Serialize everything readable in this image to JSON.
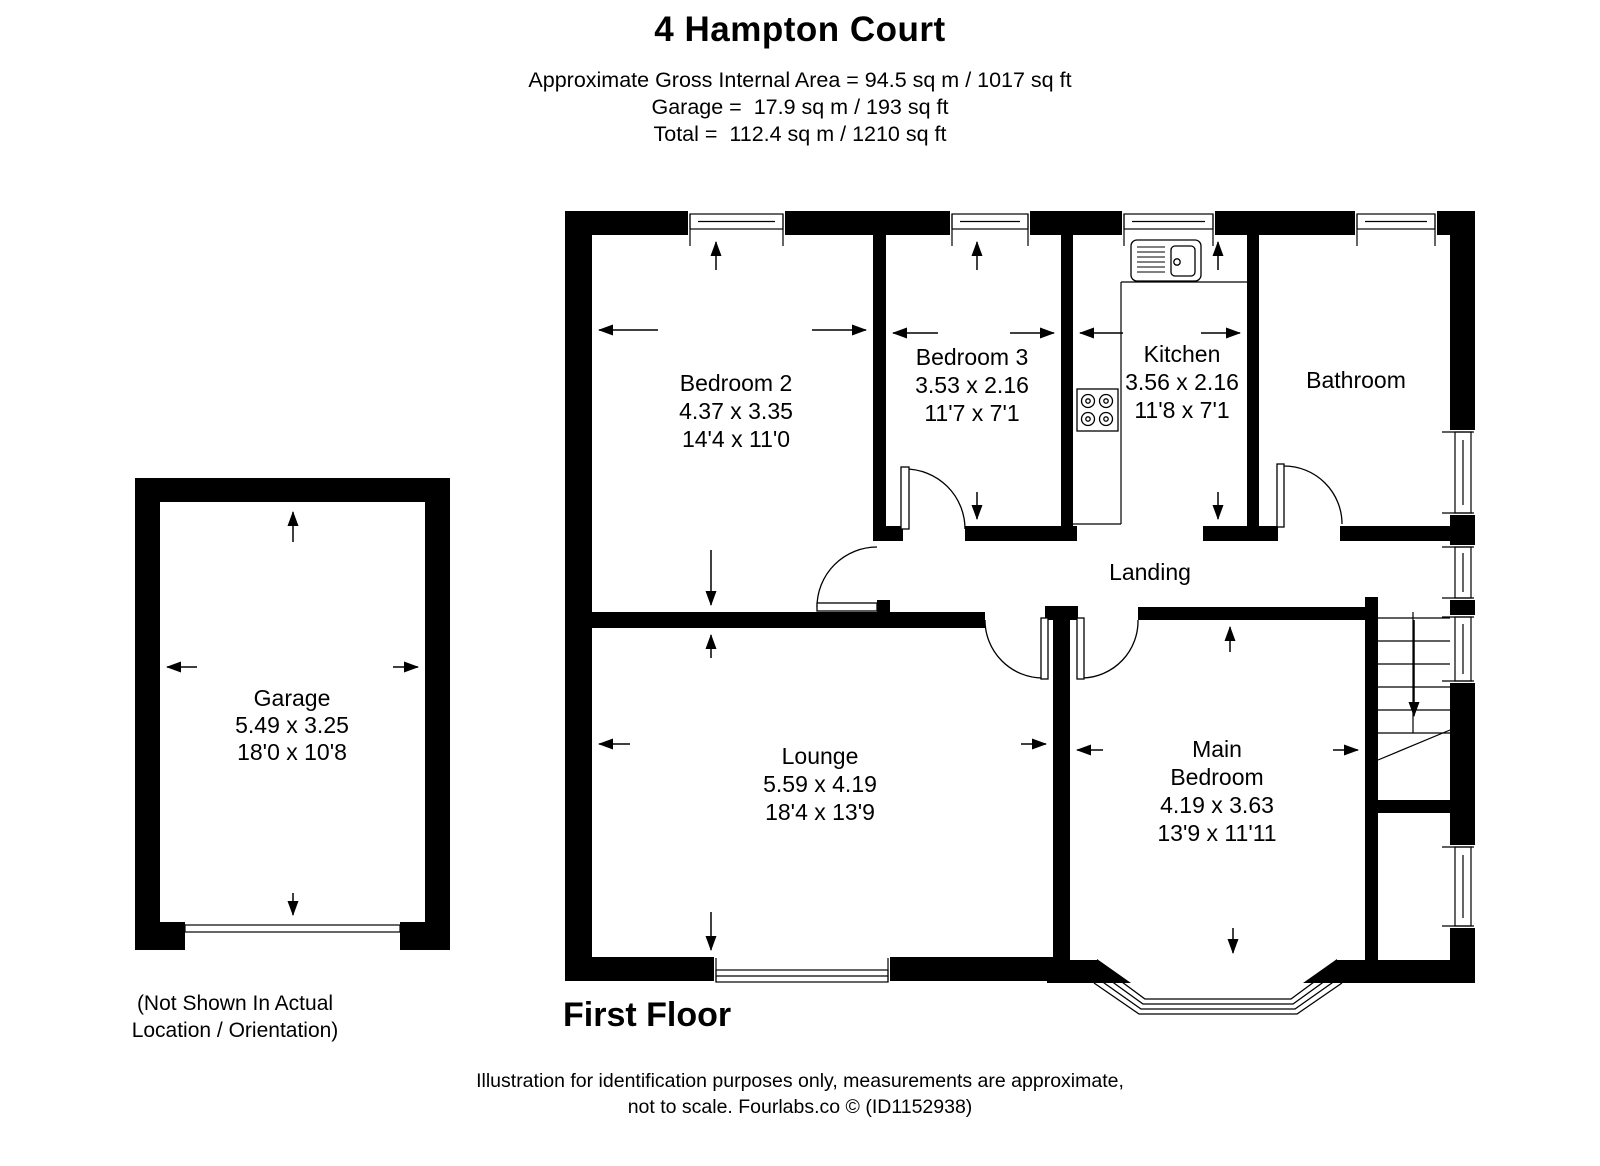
{
  "header": {
    "title": "4 Hampton Court",
    "area_line1": "Approximate Gross Internal Area = 94.5 sq m / 1017 sq ft",
    "area_line2": "Garage =  17.9 sq m / 193 sq ft",
    "area_line3": "Total =  112.4 sq m / 1210 sq ft"
  },
  "rooms": {
    "bedroom2": {
      "name": "Bedroom 2",
      "metric": "4.37 x 3.35",
      "imperial": "14'4 x 11'0"
    },
    "bedroom3": {
      "name": "Bedroom 3",
      "metric": "3.53 x 2.16",
      "imperial": "11'7 x 7'1"
    },
    "kitchen": {
      "name": "Kitchen",
      "metric": "3.56 x 2.16",
      "imperial": "11'8 x 7'1"
    },
    "bathroom": {
      "name": "Bathroom"
    },
    "landing": {
      "name": "Landing"
    },
    "lounge": {
      "name": "Lounge",
      "metric": "5.59 x 4.19",
      "imperial": "18'4 x 13'9"
    },
    "main_bedroom": {
      "name_line1": "Main",
      "name_line2": "Bedroom",
      "metric": "4.19 x 3.63",
      "imperial": "13'9 x 11'11"
    },
    "garage": {
      "name": "Garage",
      "metric": "5.49 x 3.25",
      "imperial": "18'0 x 10'8"
    }
  },
  "notes": {
    "garage_note_line1": "(Not Shown In Actual",
    "garage_note_line2": "Location / Orientation)",
    "floor_label": "First Floor",
    "disclaimer_line1": "Illustration for identification purposes only, measurements are approximate,",
    "disclaimer_line2": "not to scale. Fourlabs.co © (ID1152938)"
  },
  "icons": {
    "kitchen_sink": "sink-with-drainer",
    "kitchen_hob": "four-burner-hob",
    "stairs": "staircase-going-down",
    "bay_window": "bay-window",
    "dimension_arrow": "measurement-arrow"
  },
  "colors": {
    "wall": "#000000",
    "background": "#ffffff",
    "text": "#000000"
  }
}
